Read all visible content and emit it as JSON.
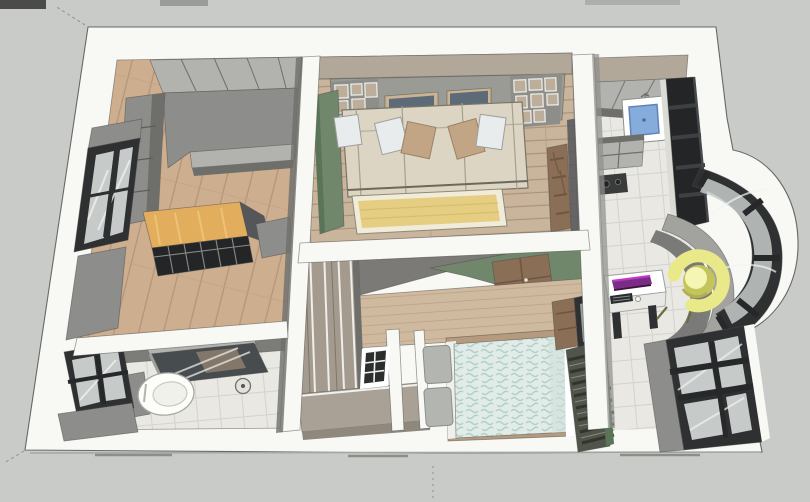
{
  "scene": {
    "type": "3d-floorplan-render",
    "style": "sketchup-overhead",
    "rooms": [
      {
        "name": "study",
        "objects": [
          "upper-wall-cabinets",
          "l-shaped-gray-counter",
          "wood-desk",
          "glass-grid-table",
          "side-cabinet",
          "west-window",
          "wood-plank-floor"
        ]
      },
      {
        "name": "living-room",
        "objects": [
          "taupe-soffit",
          "paneled-back-wall",
          "wall-shelf-grid-left",
          "wall-shelf-grid-right",
          "picture-frame-1",
          "picture-frame-2",
          "green-accent-wall",
          "three-seat-sofa",
          "throw-pillows",
          "yellow-rug",
          "marble-door-column",
          "wood-plank-floor"
        ]
      },
      {
        "name": "kitchen",
        "objects": [
          "taupe-soffit",
          "gray-counter",
          "blue-sink",
          "tall-black-cabinet",
          "base-cabinets",
          "hob",
          "tile-floor"
        ]
      },
      {
        "name": "entry-hall",
        "objects": [
          "white-desk",
          "purple-monitor",
          "keyboard",
          "mouse",
          "yellow-tub-chair",
          "curved-bay-window",
          "curved-window-sill",
          "southeast-window",
          "tile-floor"
        ]
      },
      {
        "name": "bedroom",
        "objects": [
          "ceiling-drop",
          "green-accent-wedge",
          "brown-tile-panel",
          "wood-headboard-wall",
          "wardrobe-column",
          "low-dresser",
          "bed-blue-duvet",
          "gray-pillows",
          "small-grid-window",
          "louver-blinds",
          "corner-window"
        ]
      },
      {
        "name": "bathroom",
        "objects": [
          "shower-glass-screen",
          "toilet",
          "cistern",
          "west-window",
          "vanity-cabinet",
          "floor-drain",
          "tile-floor"
        ]
      }
    ]
  },
  "palette": {
    "background": "#c9cbc8",
    "wallWhite": "#f8f8f5",
    "outline": "#4a4b49",
    "grayFace": "#8d8e8b",
    "grayLight": "#b2b3af",
    "graySide": "#6e6f6b",
    "grayDeep": "#55565a",
    "charcoal": "#2e3032",
    "black": "#232527",
    "taupe": "#b2a899",
    "green": "#70876b",
    "greenDark": "#5a7457",
    "studyFloor": "#cdaf90",
    "livingFloor": "#c9b49c",
    "deskWood": "#e2ad5c",
    "woodWall": "#cfbaa0",
    "sofa": "#dcd5c3",
    "pillowWhite": "#e9ecec",
    "pillowTan": "#c2a584",
    "rug": "#e5cd82",
    "rugBorder": "#f1ecda",
    "marble": "#8a6e56",
    "tile": "#e9e8e3",
    "tileLine": "#d4d3ce",
    "duvet": "#e1ece8",
    "duvetLine": "#b4cfc8",
    "pillowGray": "#b3b5b1",
    "blinds": "#50544a",
    "blindsDark": "#31352c",
    "sinkBlue": "#86acdc",
    "chairYellow": "#e9e98a",
    "chairYellowDark": "#c4c45c",
    "purple": "#7b2d86",
    "magenta": "#c036c8",
    "glass": "#c6cbca",
    "wardrobe": "#a49b8e",
    "dresser": "#a9a195"
  }
}
